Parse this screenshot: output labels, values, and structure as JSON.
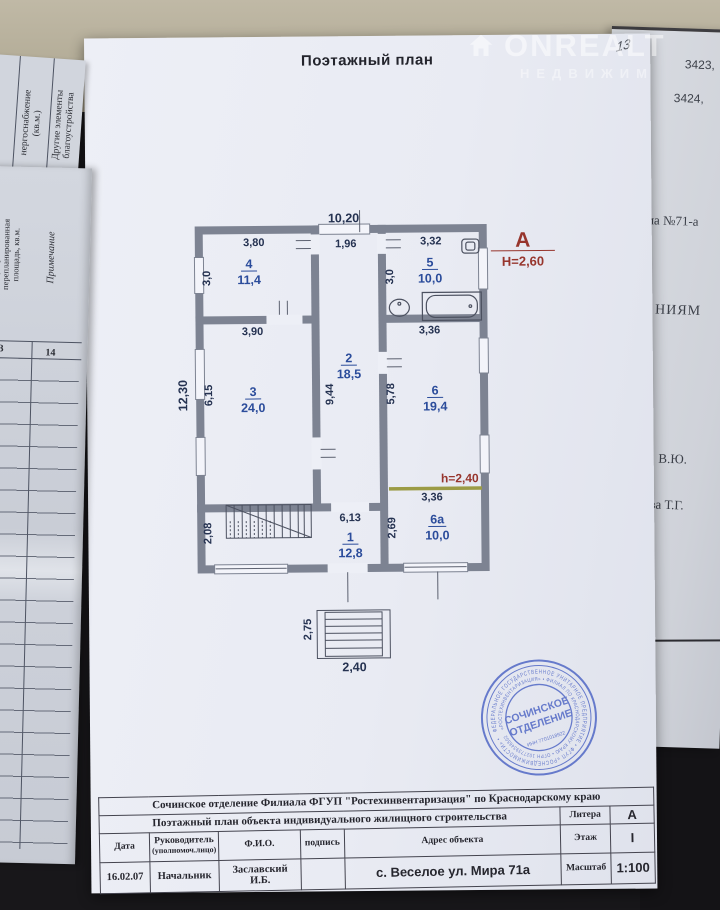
{
  "page": {
    "title": "Поэтажный план",
    "handwritten_page_number": "13"
  },
  "watermark": {
    "brand": "ONREALT",
    "subtitle": "НЕДВИЖИМ"
  },
  "plan": {
    "building_letter": "А",
    "height_label": "Н=2,60",
    "inner_height_label": "h=2,40",
    "rooms": [
      {
        "num": "4",
        "area": "11,4"
      },
      {
        "num": "5",
        "area": "10,0"
      },
      {
        "num": "2",
        "area": "18,5"
      },
      {
        "num": "3",
        "area": "24,0"
      },
      {
        "num": "6",
        "area": "19,4"
      },
      {
        "num": "6a",
        "area": "10,0"
      },
      {
        "num": "1",
        "area": "12,8"
      }
    ],
    "dims": {
      "top_width": "10,20",
      "d380": "3,80",
      "d196": "1,96",
      "d332": "3,32",
      "d30l": "3,0",
      "d30r": "3,0",
      "d390": "3,90",
      "d336a": "3,36",
      "d1230": "12,30",
      "d615": "6,15",
      "d944": "9,44",
      "d578": "5,78",
      "d613": "6,13",
      "d269": "2,69",
      "d208": "2,08",
      "d336b": "3,36",
      "d275": "2,75",
      "d240": "2,40"
    }
  },
  "stamp": {
    "outer_text": "ФЕДЕРАЛЬНОЕ ГОСУДАРСТВЕННОЕ УНИТАРНОЕ ПРЕДПРИЯТИЕ • ФГУП «РОСНЕДВИЖИМОСТИ» •",
    "inner_text": "«РОСТЕХИНВЕНТАРИЗАЦИЯ» • ФИЛИАЛ ПО КРАСНОДАРСКОМУ КРАЮ • ОГРН 1027739346502",
    "center_line1": "СОЧИНСКОЕ",
    "center_line2": "ОТДЕЛЕНИЕ",
    "center_line3": "ИНН 7701018922"
  },
  "footer_table": {
    "org_line": "Сочинское отделение Филиала ФГУП \"Ростехинвентаризация\" по Краснодарскому краю",
    "doc_line": "Поэтажный план объекта индивидуального жилищного строительства",
    "litera_label": "Литера",
    "litera_value": "А",
    "date_label": "Дата",
    "head_label": "Руководитель",
    "head_label2": "(уполномоч.лицо)",
    "fio_label": "Ф.И.О.",
    "sign_label": "подпись",
    "address_label": "Адрес объекта",
    "floor_label": "Этаж",
    "floor_value": "I",
    "date_value": "16.02.07",
    "head_value": "Начальник",
    "fio_value": "Заславский И.Б.",
    "address_value": "с. Веселое ул. Мира 71а",
    "scale_label": "Масштаб",
    "scale_value": "1:100"
  },
  "side_left": {
    "col_energy": "нергоснабжение",
    "col_energy2": "(кв.м.)",
    "col_other": "Другие элементы",
    "col_other2": "благоустройства",
    "col_replanned": "переустроенная или",
    "col_replanned2": "перепланированная",
    "col_replanned3": "площадь, кв.м.",
    "col_note": "Примечание",
    "col_num13": "13",
    "col_num14": "14"
  },
  "side_right": {
    "frag1": "3423,",
    "frag2": "3424,",
    "frag3": "ма №71-а",
    "frag4": "НИЯМ",
    "frag5": "В.Ю.",
    "frag6": "ова Т.Г."
  }
}
